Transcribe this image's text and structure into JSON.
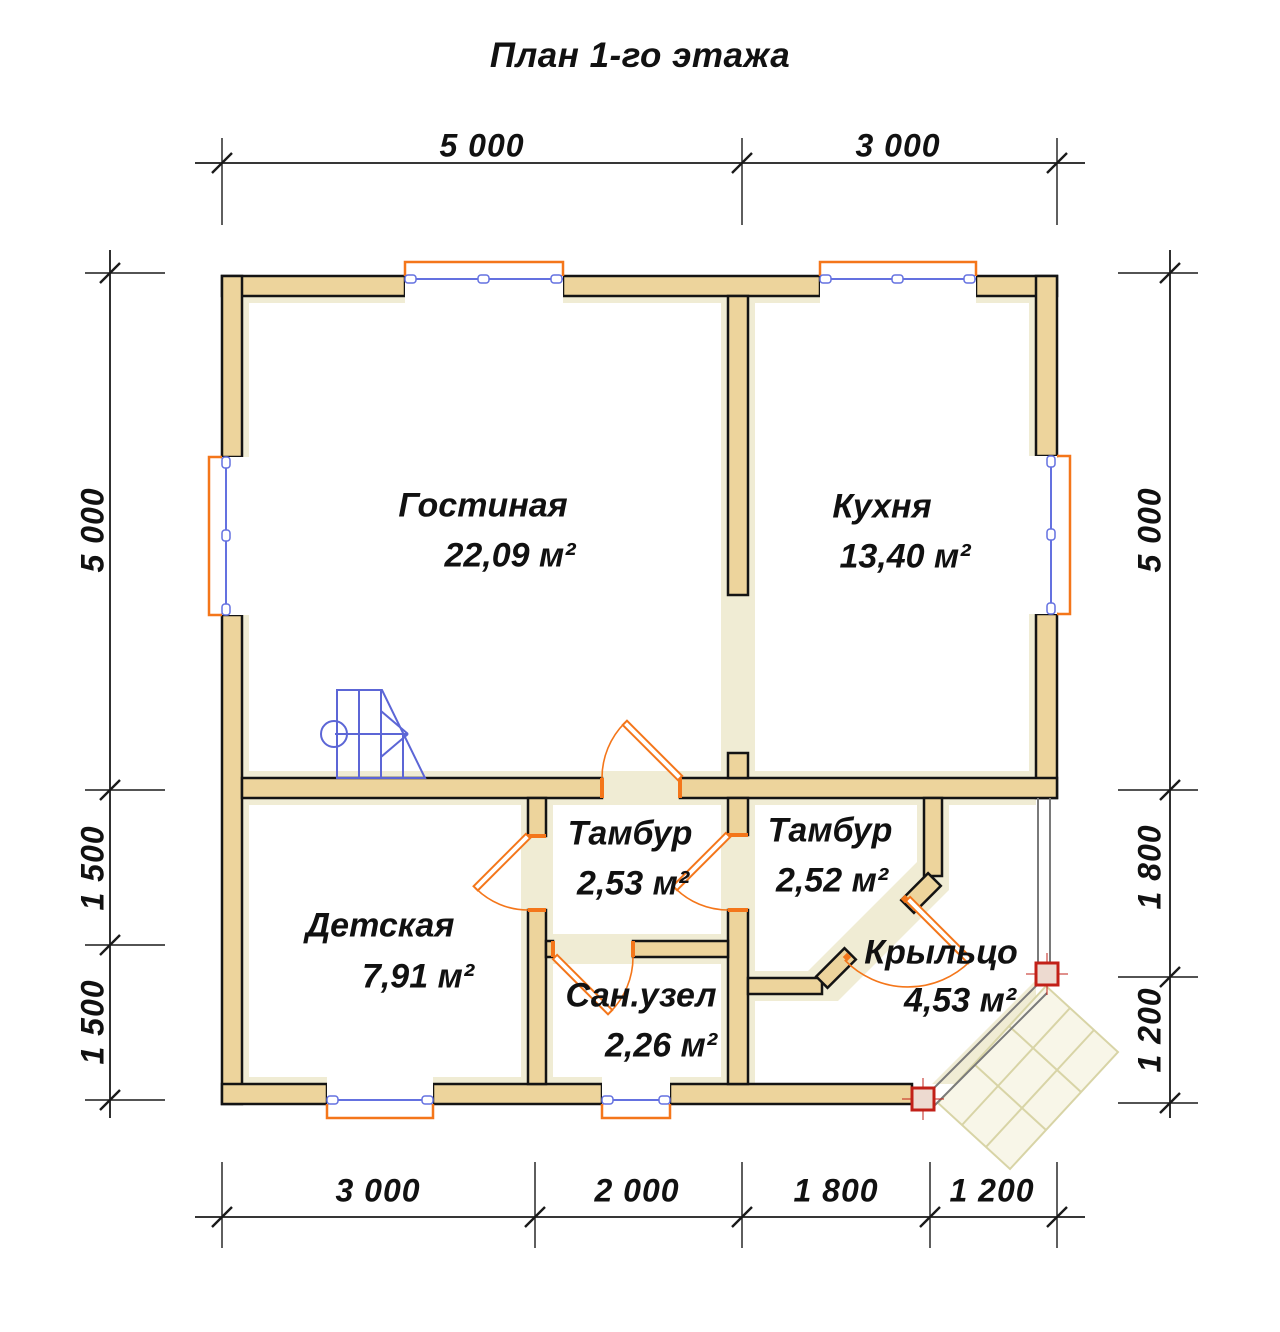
{
  "title": "План 1-го этажа",
  "rooms": [
    {
      "id": "living",
      "name": "Гостиная",
      "area": "22,09 м²"
    },
    {
      "id": "kitchen",
      "name": "Кухня",
      "area": "13,40 м²"
    },
    {
      "id": "children",
      "name": "Детская",
      "area": "7,91 м²"
    },
    {
      "id": "tambour1",
      "name": "Тамбур",
      "area": "2,53 м²"
    },
    {
      "id": "tambour2",
      "name": "Тамбур",
      "area": "2,52 м²"
    },
    {
      "id": "bathroom",
      "name": "Сан.узел",
      "area": "2,26 м²"
    },
    {
      "id": "porch",
      "name": "Крыльцо",
      "area": "4,53 м²"
    }
  ],
  "dimensions": {
    "top": [
      "5 000",
      "3 000"
    ],
    "bottom": [
      "3 000",
      "2 000",
      "1 800",
      "1 200"
    ],
    "left": [
      "5 000",
      "1 500",
      "1 500"
    ],
    "right": [
      "5 000",
      "1 800",
      "1 200"
    ]
  },
  "colors": {
    "wall_fill": "#EDD49C",
    "wall_outline": "#141414",
    "floor_strip": "#F0ECD4",
    "door_orange": "#F4761A",
    "window_blue": "#6471E0",
    "stair_blue": "#5C66D6",
    "column_red": "#C22018",
    "column_fill": "#EDDAD0",
    "porch_edge_gray": "#7A7A7A",
    "deck_fill": "#F8F6E8",
    "deck_line": "#D8D4A6"
  }
}
